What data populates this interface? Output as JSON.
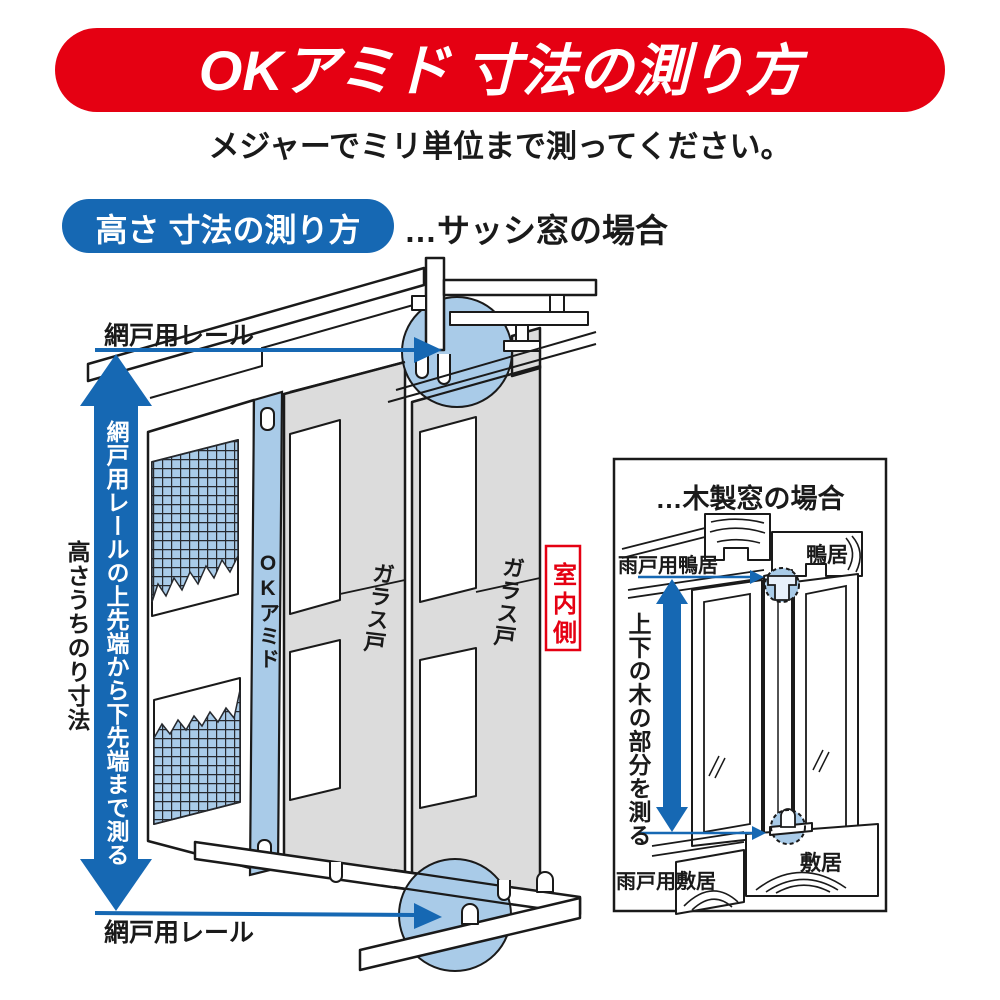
{
  "colors": {
    "red": "#e50012",
    "accent_blue": "#1668b3",
    "light_blue": "#a9cbe8",
    "panel_gray": "#dcdcdc",
    "line": "#1a1a1a"
  },
  "banner": {
    "title": "OKアミド 寸法の測り方"
  },
  "subtitle": "メジャーでミリ単位まで測ってください。",
  "section": {
    "badge": "高さ 寸法の測り方",
    "case_label": "…サッシ窓の場合"
  },
  "main": {
    "top_rail_label": "網戸用レール",
    "bottom_rail_label": "網戸用レール",
    "arrow_text": "網戸用レールの上先端から下先端まで測る",
    "height_label": "高さうちのり寸法",
    "screen_label": "OKアミド",
    "glass_door_label_1": "ガラス戸",
    "glass_door_label_2": "ガラス戸",
    "indoor_label": "室内側"
  },
  "inset": {
    "title": "…木製窓の場合",
    "top_left_label": "雨戸用鴨居",
    "top_right_label": "鴨居",
    "arrow_text": "上下の木の部分を測る",
    "bottom_left_label": "雨戸用敷居",
    "bottom_right_label": "敷居"
  }
}
